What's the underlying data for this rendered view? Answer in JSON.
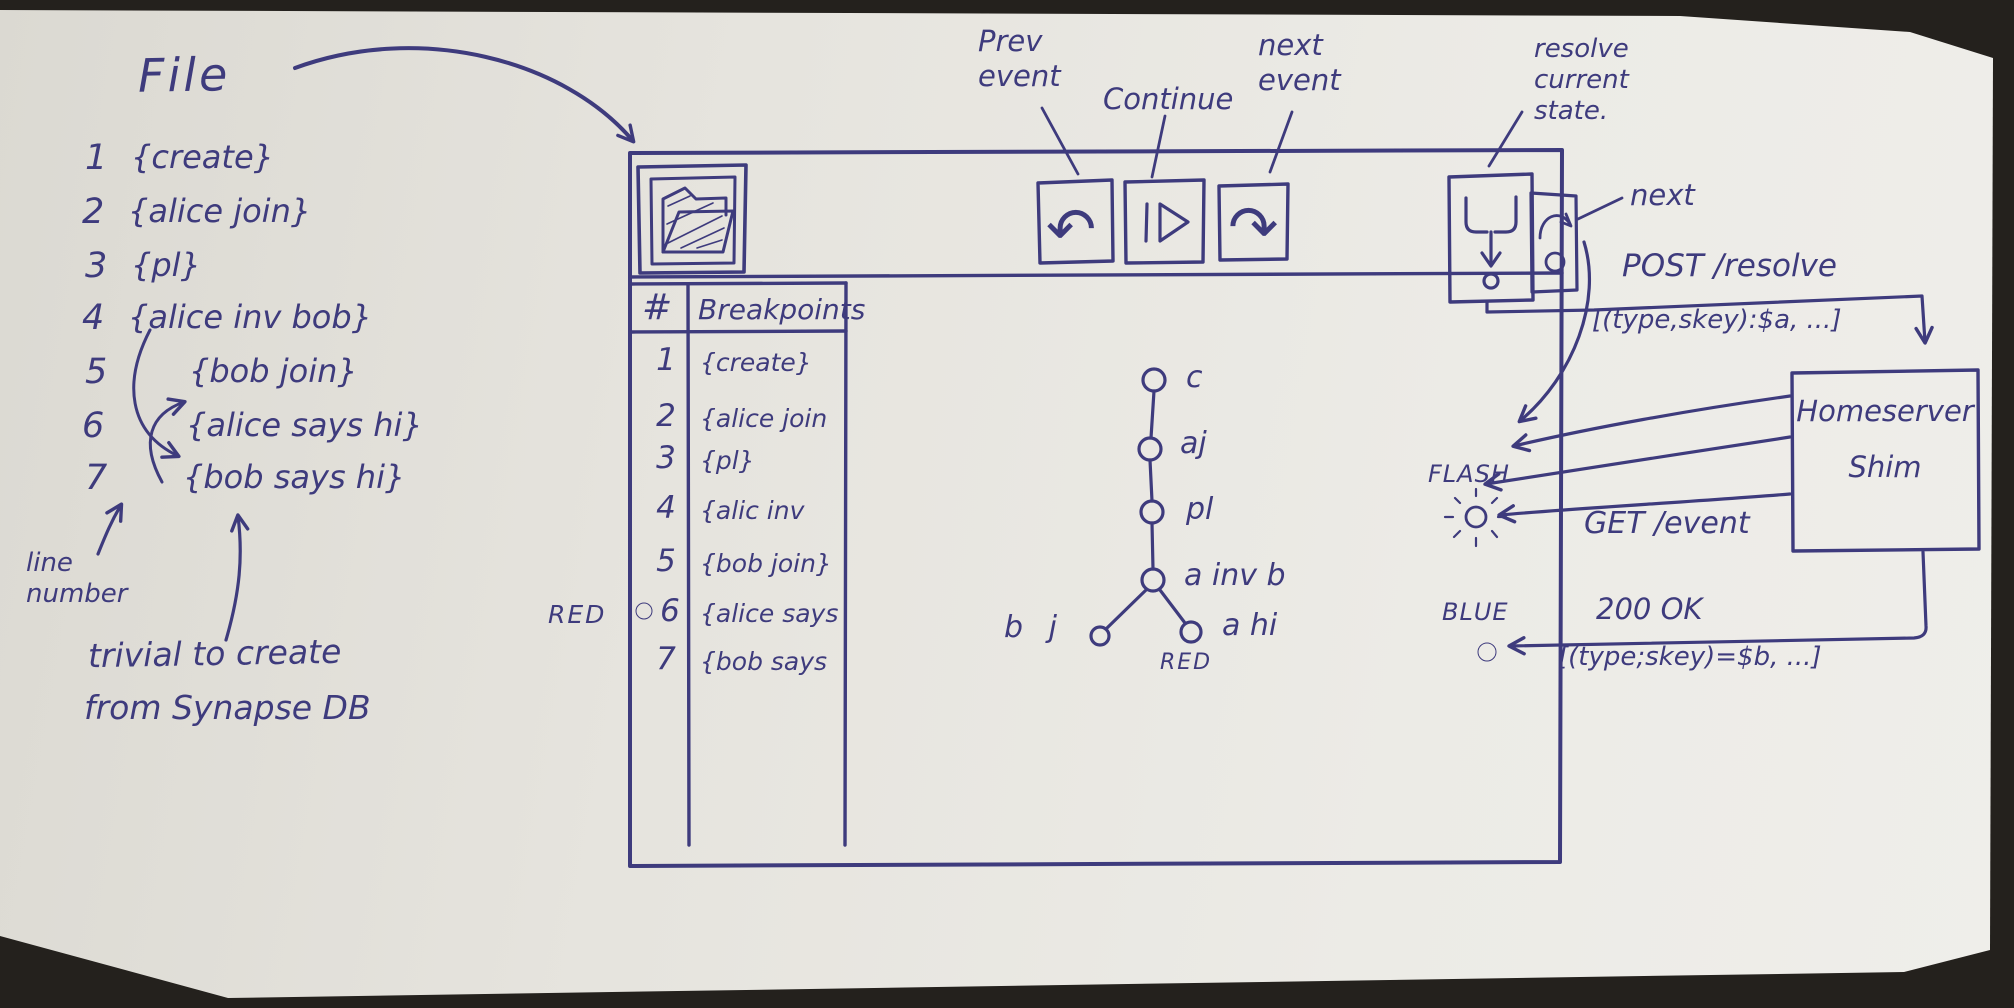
{
  "colors": {
    "ink": "#3e3b7d",
    "paper": "#e8e6e0",
    "background": "#24211d"
  },
  "annotations": {
    "file_heading": "File",
    "file_lines": [
      {
        "num": "1",
        "text": "{create}"
      },
      {
        "num": "2",
        "text": "{alice join}"
      },
      {
        "num": "3",
        "text": "{pl}"
      },
      {
        "num": "4",
        "text": "{alice inv bob}"
      },
      {
        "num": "5",
        "text": "{bob join}"
      },
      {
        "num": "6",
        "text": "{alice says hi}"
      },
      {
        "num": "7",
        "text": "{bob says hi}"
      }
    ],
    "line_number_note": "line number",
    "trivial_line1": "trivial to create",
    "trivial_line2": "from Synapse DB",
    "prev_label": "Prev event",
    "continue_label": "Continue",
    "next_label": "next event",
    "resolve_label": "resolve current state.",
    "next_state_label": "next",
    "red_breakpoint_label": "RED"
  },
  "window": {
    "breakpoints": {
      "header_num": "#",
      "header_title": "Breakpoints",
      "rows": [
        {
          "num": "1",
          "text": "{create}"
        },
        {
          "num": "2",
          "text": "{alice join"
        },
        {
          "num": "3",
          "text": "{pl}"
        },
        {
          "num": "4",
          "text": "{alic inv"
        },
        {
          "num": "5",
          "text": "{bob join}"
        },
        {
          "num": "6",
          "text": "{alice says"
        },
        {
          "num": "7",
          "text": "{bob says"
        }
      ],
      "active_breakpoint_row": "6"
    },
    "dag": {
      "nodes": [
        {
          "id": "c",
          "label": "c"
        },
        {
          "id": "aj",
          "label": "aj"
        },
        {
          "id": "pl",
          "label": "pl"
        },
        {
          "id": "a-inv-b",
          "label": "a inv b"
        },
        {
          "id": "b-j",
          "label": "b j"
        },
        {
          "id": "a-hi",
          "label": "a hi"
        }
      ],
      "red_label": "RED"
    }
  },
  "shim": {
    "box_line1": "Homeserver",
    "box_line2": "Shim",
    "post_title": "POST /resolve",
    "post_payload": "[(type,skey):$a, ...]",
    "get_label": "GET /event",
    "ok_title": "200 OK",
    "ok_payload": "[(type;skey)=$b, ...]",
    "flash_label": "FLASH",
    "blue_label": "BLUE"
  },
  "icons": {
    "undo": "↶",
    "redo": "↷",
    "names": [
      "folder-open-icon",
      "undo-icon",
      "play-icon",
      "redo-icon",
      "merge-resolve-icon",
      "step-next-icon",
      "breakpoint-dot",
      "flash-burst-icon",
      "blue-dot"
    ]
  }
}
